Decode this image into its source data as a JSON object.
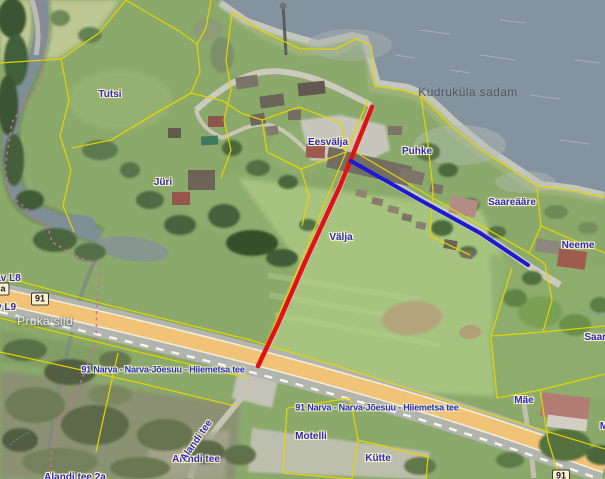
{
  "map": {
    "water_label": {
      "text": "Kudruküla sadam",
      "x": 468,
      "y": 92
    },
    "bridge_label": {
      "text": "Pruka sild",
      "x": 45,
      "y": 321
    },
    "parcel_labels": [
      {
        "text": "Tutsi",
        "x": 110,
        "y": 95
      },
      {
        "text": "Jüri",
        "x": 163,
        "y": 183
      },
      {
        "text": "Eesvälja",
        "x": 328,
        "y": 143
      },
      {
        "text": "Puhke",
        "x": 417,
        "y": 152
      },
      {
        "text": "Välja",
        "x": 341,
        "y": 238
      },
      {
        "text": "Saareääre",
        "x": 512,
        "y": 203
      },
      {
        "text": "Neeme",
        "x": 578,
        "y": 246
      },
      {
        "text": "Saare",
        "x": 598,
        "y": 338
      },
      {
        "text": "Mäe",
        "x": 524,
        "y": 401
      },
      {
        "text": "Motelli",
        "x": 311,
        "y": 437
      },
      {
        "text": "Kütte",
        "x": 378,
        "y": 459
      },
      {
        "text": "Alandi tee",
        "x": 196,
        "y": 460
      },
      {
        "text": "Alandi tee 2a",
        "x": 75,
        "y": 478
      },
      {
        "text": "av L8",
        "x": 8,
        "y": 279
      },
      {
        "text": "v L9",
        "x": 6,
        "y": 308
      },
      {
        "text": "M",
        "x": 604,
        "y": 427
      }
    ],
    "rotated_street_label": {
      "text": "Alandi tee",
      "x": 197,
      "y": 441,
      "angle": -55
    },
    "road_labels": [
      {
        "text": "91 Narva - Narva-Jõesuu - Hiiemetsa tee",
        "x": 163,
        "y": 370
      },
      {
        "text": "91 Narva - Narva-Jõesuu - Hiiemetsa tee",
        "x": 377,
        "y": 408
      }
    ],
    "road_badges": [
      {
        "text": "91",
        "x": 40,
        "y": 299
      },
      {
        "text": "91",
        "x": 561,
        "y": 476
      },
      {
        "text": "a",
        "x": 3,
        "y": 289
      }
    ],
    "route_lines": [
      {
        "name": "red-route",
        "color": "#e01212"
      },
      {
        "name": "blue-route",
        "color": "#1b1bd0"
      }
    ],
    "colors": {
      "water": "#8593a0",
      "beach": "#c4c7bb",
      "cadastral_line": "#e5d400",
      "highway": "#f1c377",
      "gravel_road": "#ccc9bd",
      "parcel_label_blue": "#2a2acc",
      "trail_pink": "#cc6b9e"
    }
  }
}
